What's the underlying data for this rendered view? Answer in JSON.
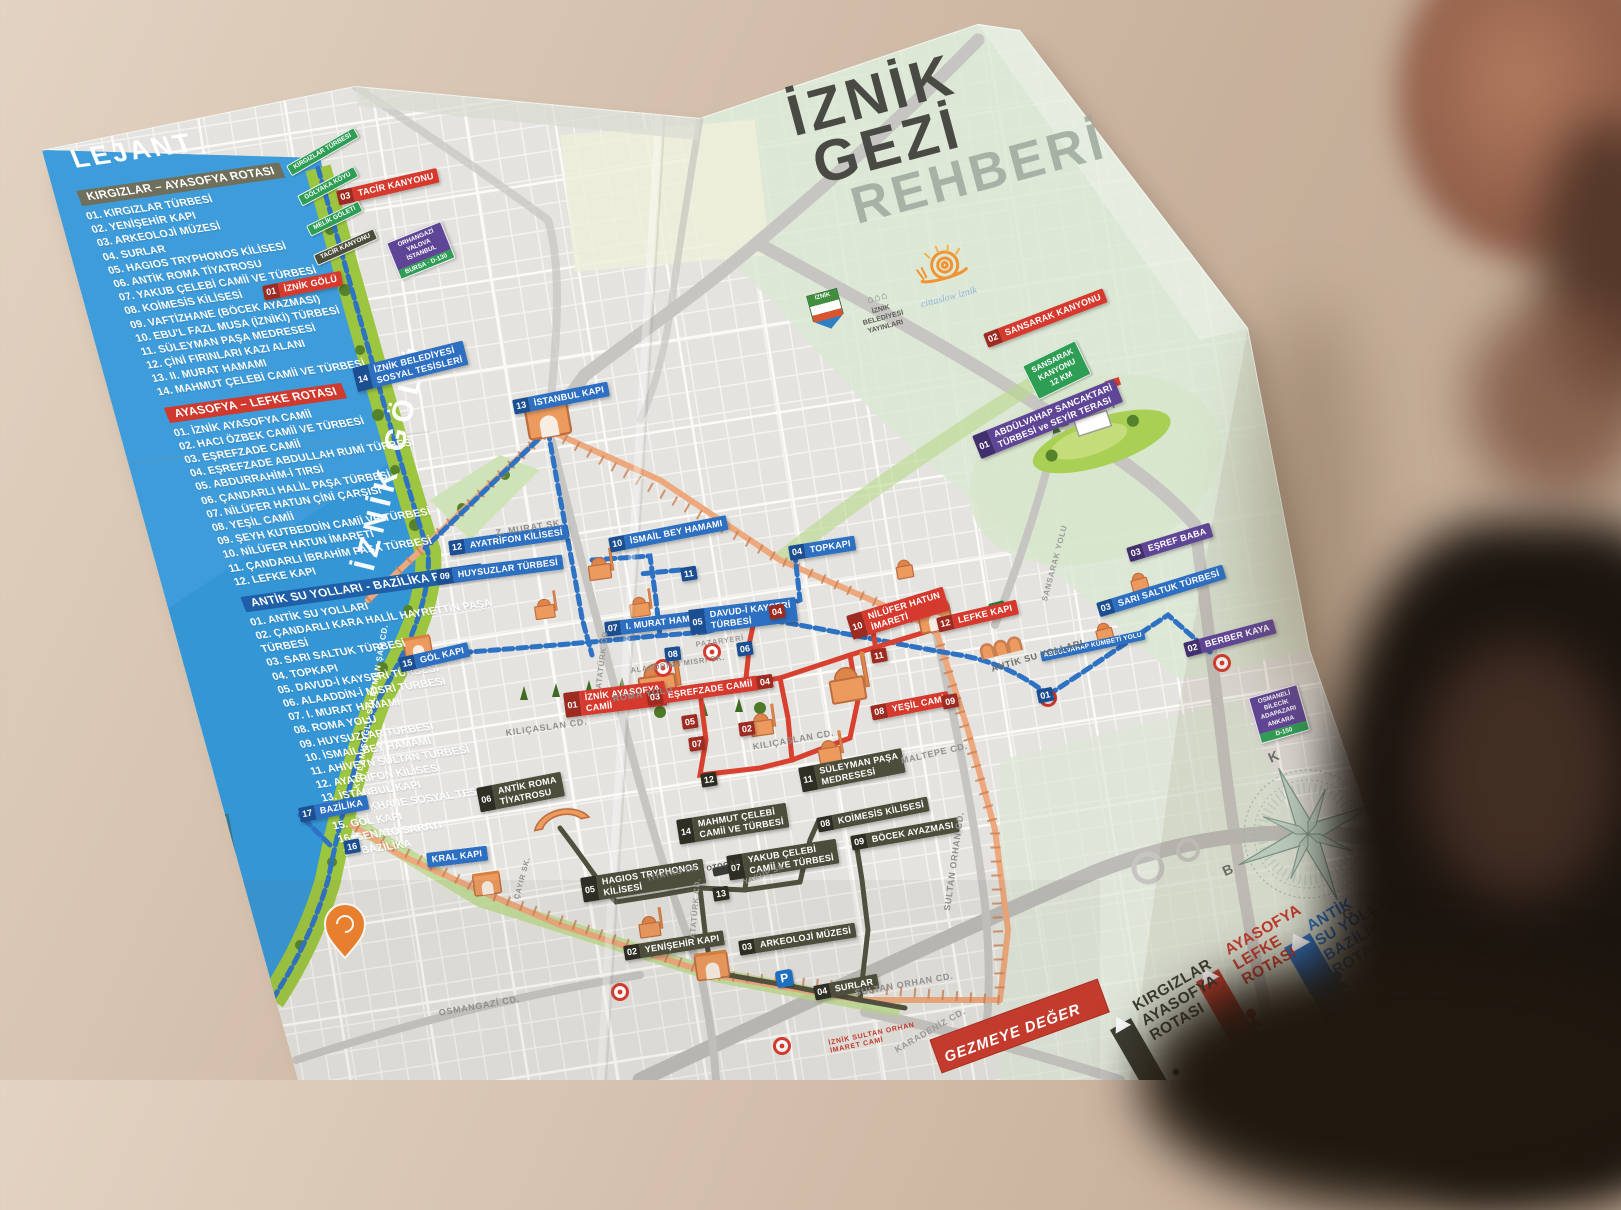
{
  "title": {
    "l1": "İZNİK",
    "l2": "GEZİ",
    "l3": "REHBERİ"
  },
  "publisher": {
    "crest": "İZNİK",
    "lines": "İZNİK\nBELEDİYESİ\nYAYINLARI",
    "cittaslow": "cittaslow iznik"
  },
  "lake_label": "İZNİK GÖLÜ",
  "ribbon": "GEZMEYE DEĞER",
  "parking_label": "P",
  "compass": {
    "n": "K",
    "e": "D",
    "s": "G",
    "w": "B"
  },
  "colors": {
    "lake": "#3596d6",
    "route_blue": "#2d6fc1",
    "route_red": "#d63a2e",
    "route_dark": "#4d4d3c",
    "route_purple": "#5f4596",
    "wall_orange": "#eda87d",
    "shore_green": "#9cc63f"
  },
  "legend": {
    "heading": "LEJANT",
    "sections": [
      {
        "title": "KIRGIZLAR – AYASOFYA ROTASI",
        "color": "#6f6f5c",
        "items": [
          "01.  KIRGIZLAR TÜRBESİ",
          "02.  YENİŞEHİR KAPI",
          "03.  ARKEOLOJİ MÜZESİ",
          "04.  SURLAR",
          "05.  HAGIOS TRYPHONOS KİLİSESİ",
          "06.  ANTİK ROMA TİYATROSU",
          "07.  YAKUB ÇELEBİ CAMİİ VE TÜRBESİ",
          "08.  KOİMESİS KİLİSESİ",
          "09.  VAFTİZHANE (BÖCEK AYAZMASI)",
          "10.  EBU'L FAZL MUSA (İZNİKİ) TÜRBESİ",
          "11.  SÜLEYMAN PAŞA MEDRESESİ",
          "12.  ÇİNİ FIRINLARI KAZI ALANI",
          "13.  II. MURAT HAMAMI",
          "14.  MAHMUT ÇELEBİ CAMİİ VE TÜRBESİ"
        ]
      },
      {
        "title": "AYASOFYA – LEFKE ROTASI",
        "color": "#d0392e",
        "items": [
          "01.  İZNİK AYASOFYA CAMİİ",
          "02.  HACI ÖZBEK CAMİİ VE TÜRBESİ",
          "03.  EŞREFZADE CAMİİ",
          "04.  EŞREFZADE ABDULLAH RUMİ TÜRBESİ",
          "05.  ABDURRAHİM-İ TIRSİ",
          "06.  ÇANDARLI HALİL PAŞA TÜRBESİ",
          "07.  NİLÜFER HATUN ÇİNİ ÇARŞISI",
          "08.  YEŞİL CAMİİ",
          "09.  ŞEYH KUTBEDDİN CAMİİ VE TÜRBESİ",
          "10.  NİLÜFER HATUN İMARETİ",
          "11.  ÇANDARLI İBRAHİM PAŞA TÜRBESİ",
          "12.  LEFKE KAPI"
        ]
      },
      {
        "title": "ANTİK SU YOLLARI - BAZİLİKA ROTASI",
        "color": "#1f5fa8",
        "items": [
          "01.  ANTİK SU YOLLARI",
          "02.  ÇANDARLI KARA HALİL HAYRETTİN PAŞA TÜRBESİ",
          "03.  SARI SALTUK TÜRBESİ",
          "04.  TOPKAPI",
          "05.  DAVUD-İ KAYSERİ TÜRBESİ",
          "06.  ALAADDİN-İ MISRİ TÜRBESİ",
          "07.  I. MURAT HAMAMI",
          "08.  ROMA YOLU",
          "09.  HUYSUZLAR TÜRBESİ",
          "10.  İSMAİL BEY HAMAMI",
          "11.  AHİVEYN SULTAN TÜRBESİ",
          "12.  AYATRİFON KİLİSESİ",
          "13.  İSTANBUL KAPI",
          "14.  KAYIKHANE SOSYAL TESİSLERİ",
          "15.  GÖL KAPI",
          "16.  SENATO SARAYI",
          "17.  BAZİLİKA"
        ]
      }
    ]
  },
  "map": {
    "badges": [
      {
        "n": "14",
        "t": "İZNİK BELEDİYESİ\nSOSYAL TESİSLERİ",
        "v": "b",
        "x": 352,
        "y": 368,
        "r": -14
      },
      {
        "n": "13",
        "t": "İSTANBUL KAPI",
        "v": "b",
        "x": 512,
        "y": 400,
        "r": -11
      },
      {
        "n": "12",
        "t": "AYATRİFON KİLİSESİ",
        "v": "b",
        "x": 448,
        "y": 541,
        "r": -8
      },
      {
        "n": "09",
        "t": "HUYSUZLAR TÜRBESİ",
        "v": "b",
        "x": 436,
        "y": 570,
        "r": -7
      },
      {
        "n": "10",
        "t": "İSMAİL BEY HAMAMI",
        "v": "b",
        "x": 608,
        "y": 538,
        "r": -11
      },
      {
        "n": "11",
        "t": "",
        "v": "b",
        "x": 680,
        "y": 568,
        "r": -9
      },
      {
        "n": "04",
        "t": "TOPKAPI",
        "v": "b",
        "x": 788,
        "y": 546,
        "r": -9
      },
      {
        "n": "07",
        "t": "I. MURAT HAMAMI",
        "v": "b",
        "x": 604,
        "y": 622,
        "r": -7
      },
      {
        "n": "05",
        "t": "DAVUD-İ KAYSERİ\nTÜRBESİ",
        "v": "b",
        "x": 688,
        "y": 610,
        "r": -7
      },
      {
        "n": "08",
        "t": "",
        "v": "b",
        "x": 664,
        "y": 648,
        "r": -7
      },
      {
        "n": "06",
        "t": "",
        "v": "b",
        "x": 736,
        "y": 643,
        "r": -8
      },
      {
        "n": "15",
        "t": "GÖL KAPI",
        "v": "b",
        "x": 398,
        "y": 658,
        "r": -13
      },
      {
        "n": "17",
        "t": "BAZİLİKA",
        "v": "b",
        "x": 298,
        "y": 808,
        "r": -11
      },
      {
        "n": "16",
        "t": "",
        "v": "b",
        "x": 343,
        "y": 841,
        "r": -10
      },
      {
        "n": "",
        "t": "KRAL KAPI",
        "v": "b",
        "x": 426,
        "y": 853,
        "r": -7
      },
      {
        "n": "03",
        "t": "SARI SALTUK TÜRBESİ",
        "v": "b",
        "x": 1096,
        "y": 603,
        "r": -17
      },
      {
        "n": "01",
        "t": "",
        "v": "b",
        "x": 1036,
        "y": 690,
        "r": -12
      },
      {
        "n": "",
        "t": "ABDÜLVAHAP KÜMBETİ YOLU",
        "v": "bs",
        "x": 1040,
        "y": 652,
        "r": -12
      },
      {
        "n": "02",
        "t": "",
        "v": "g",
        "x": 988,
        "y": 604,
        "r": -14
      },
      {
        "n": "01",
        "t": "İZNİK GÖLÜ",
        "v": "r",
        "x": 262,
        "y": 286,
        "r": -11
      },
      {
        "n": "03",
        "t": "TACİR KANYONU",
        "v": "r",
        "x": 336,
        "y": 191,
        "r": -13
      },
      {
        "n": "02",
        "t": "SANSARAK KANYONU",
        "v": "r",
        "x": 983,
        "y": 334,
        "r": -21
      },
      {
        "n": "01",
        "t": "İZNİK AYASOFYA\nCAMİİ",
        "v": "r",
        "x": 563,
        "y": 693,
        "r": -7
      },
      {
        "n": "03",
        "t": "EŞREFZADE CAMİİ",
        "v": "r",
        "x": 646,
        "y": 691,
        "r": -8
      },
      {
        "n": "10",
        "t": "NİLÜFER HATUN\nİMARETİ",
        "v": "r",
        "x": 846,
        "y": 616,
        "r": -17
      },
      {
        "n": "12",
        "t": "LEFKE KAPI",
        "v": "r",
        "x": 936,
        "y": 618,
        "r": -13
      },
      {
        "n": "08",
        "t": "YEŞİL CAMİ",
        "v": "r",
        "x": 870,
        "y": 706,
        "r": -11
      },
      {
        "n": "04",
        "t": "",
        "v": "r",
        "x": 768,
        "y": 606,
        "r": -9
      },
      {
        "n": "11",
        "t": "",
        "v": "r",
        "x": 870,
        "y": 650,
        "r": -10
      },
      {
        "n": "09",
        "t": "",
        "v": "r",
        "x": 941,
        "y": 696,
        "r": -11
      },
      {
        "n": "02",
        "t": "",
        "v": "r",
        "x": 738,
        "y": 723,
        "r": -8
      },
      {
        "n": "05",
        "t": "",
        "v": "r",
        "x": 681,
        "y": 716,
        "r": -8
      },
      {
        "n": "04",
        "t": "",
        "v": "r",
        "x": 756,
        "y": 676,
        "r": -8
      },
      {
        "n": "07",
        "t": "",
        "v": "r",
        "x": 688,
        "y": 738,
        "r": -8
      },
      {
        "n": "06",
        "t": "ANTİK ROMA\nTİYATROSU",
        "v": "o",
        "x": 476,
        "y": 788,
        "r": -11
      },
      {
        "n": "05",
        "t": "HAGIOS TRYPHONOS\nKİLİSESİ",
        "v": "o",
        "x": 580,
        "y": 878,
        "r": -9
      },
      {
        "n": "02",
        "t": "YENİŞEHİR KAPI",
        "v": "o",
        "x": 623,
        "y": 946,
        "r": -9
      },
      {
        "n": "03",
        "t": "ARKEOLOJİ MÜZESİ",
        "v": "o",
        "x": 738,
        "y": 941,
        "r": -9
      },
      {
        "n": "04",
        "t": "SURLAR",
        "v": "o",
        "x": 813,
        "y": 986,
        "r": -11
      },
      {
        "n": "07",
        "t": "YAKUB ÇELEBİ\nCAMİİ VE TÜRBESİ",
        "v": "o",
        "x": 726,
        "y": 856,
        "r": -9
      },
      {
        "n": "08",
        "t": "KOİMESİS KİLİSESİ",
        "v": "o",
        "x": 816,
        "y": 818,
        "r": -11
      },
      {
        "n": "09",
        "t": "BÖCEK AYAZMASI",
        "v": "o",
        "x": 850,
        "y": 836,
        "r": -10
      },
      {
        "n": "11",
        "t": "SÜLEYMAN PAŞA\nMEDRESESİ",
        "v": "o",
        "x": 798,
        "y": 768,
        "r": -11
      },
      {
        "n": "14",
        "t": "MAHMUT ÇELEBİ\nCAMİİ VE TÜRBESİ",
        "v": "o",
        "x": 676,
        "y": 820,
        "r": -9
      },
      {
        "n": "12",
        "t": "",
        "v": "o",
        "x": 700,
        "y": 774,
        "r": -9
      },
      {
        "n": "13",
        "t": "",
        "v": "o",
        "x": 712,
        "y": 888,
        "r": -9
      },
      {
        "n": "01",
        "t": "ABDÜLVAHAP SANCAKTARİ\nTÜRBESİ ve SEYİR TERASI",
        "v": "p",
        "x": 972,
        "y": 436,
        "r": -22
      },
      {
        "n": "03",
        "t": "EŞREF BABA",
        "v": "p",
        "x": 1126,
        "y": 548,
        "r": -17
      },
      {
        "n": "02",
        "t": "BERBER KAYA",
        "v": "p",
        "x": 1183,
        "y": 643,
        "r": -15
      }
    ],
    "streets": [
      {
        "t": "KUTLAMIŞOĞLU SÜLEYMAN ŞAH CD.",
        "x": 352,
        "y": 788,
        "r": -80,
        "s": 8,
        "c": "#ffffff"
      },
      {
        "t": "KILIÇASLAN CD.",
        "x": 505,
        "y": 728,
        "r": -8,
        "s": 9,
        "c": "#8f8f8c"
      },
      {
        "t": "KILIÇASLAN CD.",
        "x": 752,
        "y": 742,
        "r": -10,
        "s": 9,
        "c": "#8f8f8c"
      },
      {
        "t": "ROMA YOLU",
        "x": 612,
        "y": 694,
        "r": -9,
        "s": 9,
        "c": "#8f8f8c"
      },
      {
        "t": "ALAADDİN-İ MISRİ SK.",
        "x": 630,
        "y": 666,
        "r": -8,
        "s": 7.5,
        "c": "#8f8f8c"
      },
      {
        "t": "Z. MURAT SK.",
        "x": 495,
        "y": 528,
        "r": -9,
        "s": 9,
        "c": "#8f8f8c"
      },
      {
        "t": "ATATÜRK CD.",
        "x": 594,
        "y": 688,
        "r": -83,
        "s": 8,
        "c": "#9a9a96"
      },
      {
        "t": "ATATÜRK CD.",
        "x": 688,
        "y": 938,
        "r": -85,
        "s": 8,
        "c": "#9a9a96"
      },
      {
        "t": "MALTEPE CD.",
        "x": 900,
        "y": 756,
        "r": -13,
        "s": 9,
        "c": "#8f8f8c"
      },
      {
        "t": "SULTAN ORHAN CD.",
        "x": 942,
        "y": 910,
        "r": -82,
        "s": 9,
        "c": "#8f8f8c"
      },
      {
        "t": "SULTAN ORHAN CD.",
        "x": 854,
        "y": 988,
        "r": -10,
        "s": 9,
        "c": "#8f8f8c"
      },
      {
        "t": "KARADENİZ CD.",
        "x": 893,
        "y": 1046,
        "r": -30,
        "s": 9,
        "c": "#9a9a96"
      },
      {
        "t": "OSMANGAZİ CD.",
        "x": 438,
        "y": 1008,
        "r": -10,
        "s": 9,
        "c": "#8f8f8c"
      },
      {
        "t": "TİYATRO SK.",
        "x": 646,
        "y": 874,
        "r": -12,
        "s": 7.5,
        "c": "#8f8f8c"
      },
      {
        "t": "YAKUP SK.",
        "x": 742,
        "y": 878,
        "r": -22,
        "s": 7.5,
        "c": "#8f8f8c"
      },
      {
        "t": "ÇAYIR SK.",
        "x": 512,
        "y": 898,
        "r": -75,
        "s": 7.5,
        "c": "#8f8f8c"
      },
      {
        "t": "SANSARAK YOLU",
        "x": 1040,
        "y": 600,
        "r": -75,
        "s": 8,
        "c": "#9a9a96"
      },
      {
        "t": "PAZARYERİ",
        "x": 695,
        "y": 640,
        "r": -8,
        "s": 7.5,
        "c": "#9a9a96"
      },
      {
        "t": "ANTİK SU YOLLARI",
        "x": 990,
        "y": 664,
        "r": -16,
        "s": 9,
        "c": "#6b6b66"
      },
      {
        "t": "OTOGAR",
        "x": 706,
        "y": 866,
        "r": -12,
        "s": 7,
        "c": "#4a4a46"
      },
      {
        "t": "İZNİK SULTAN ORHAN\nİMARET CAMİ",
        "x": 828,
        "y": 1040,
        "r": -12,
        "s": 7,
        "c": "#c0392b"
      }
    ],
    "signs_green": [
      {
        "t": "KIRGIZLAR TÜRBESİ",
        "x": 286,
        "y": 166,
        "r": -30,
        "dark": false
      },
      {
        "t": "GÖLYAKA KÖYÜ",
        "x": 297,
        "y": 196,
        "r": -28,
        "dark": false
      },
      {
        "t": "MELİK GÖLETİ",
        "x": 306,
        "y": 226,
        "r": -26,
        "dark": false
      },
      {
        "t": "TACİR KANYONU",
        "x": 313,
        "y": 255,
        "r": -24,
        "dark": true
      }
    ],
    "sign_big": {
      "t": "SANSARAK\nKANYONU\n12 KM",
      "x": 1022,
      "y": 366,
      "r": -26
    },
    "hsigns": [
      {
        "lines": "ORHANGAZİ\nYALOVA\nİSTANBUL",
        "road": "BURSA · D-130",
        "x": 386,
        "y": 243,
        "r": -22
      },
      {
        "lines": "OSMANELİ\nBİLECİK\nADAPAZARI\nANKARA",
        "road": "D-150",
        "x": 1248,
        "y": 698,
        "r": -16
      }
    ]
  },
  "routes_legend": [
    {
      "label": "KIRGIZLAR\nAYASOFYA\nROTASI",
      "c": "#3e3e33",
      "x": 1130,
      "y": 1000,
      "r": -30,
      "time": "",
      "tx": 0,
      "ty": 0
    },
    {
      "label": "AYASOFYA\nLEFKE\nROTASI",
      "c": "#c13a2c",
      "x": 1222,
      "y": 944,
      "r": -30,
      "time": "45 dk",
      "tx": 1284,
      "ty": 1052
    },
    {
      "label": "ANTİK\nSU YOLLARI\nBAZİLİKA\nROTASI",
      "c": "#2d6fc1",
      "x": 1304,
      "y": 920,
      "r": -30,
      "time": "60 dk",
      "tx": 1354,
      "ty": 1030
    },
    {
      "label": "DİĞER\nYAPILAR",
      "c": "#5f4596",
      "x": 1390,
      "y": 894,
      "r": -30,
      "time": "",
      "tx": 0,
      "ty": 0
    }
  ]
}
